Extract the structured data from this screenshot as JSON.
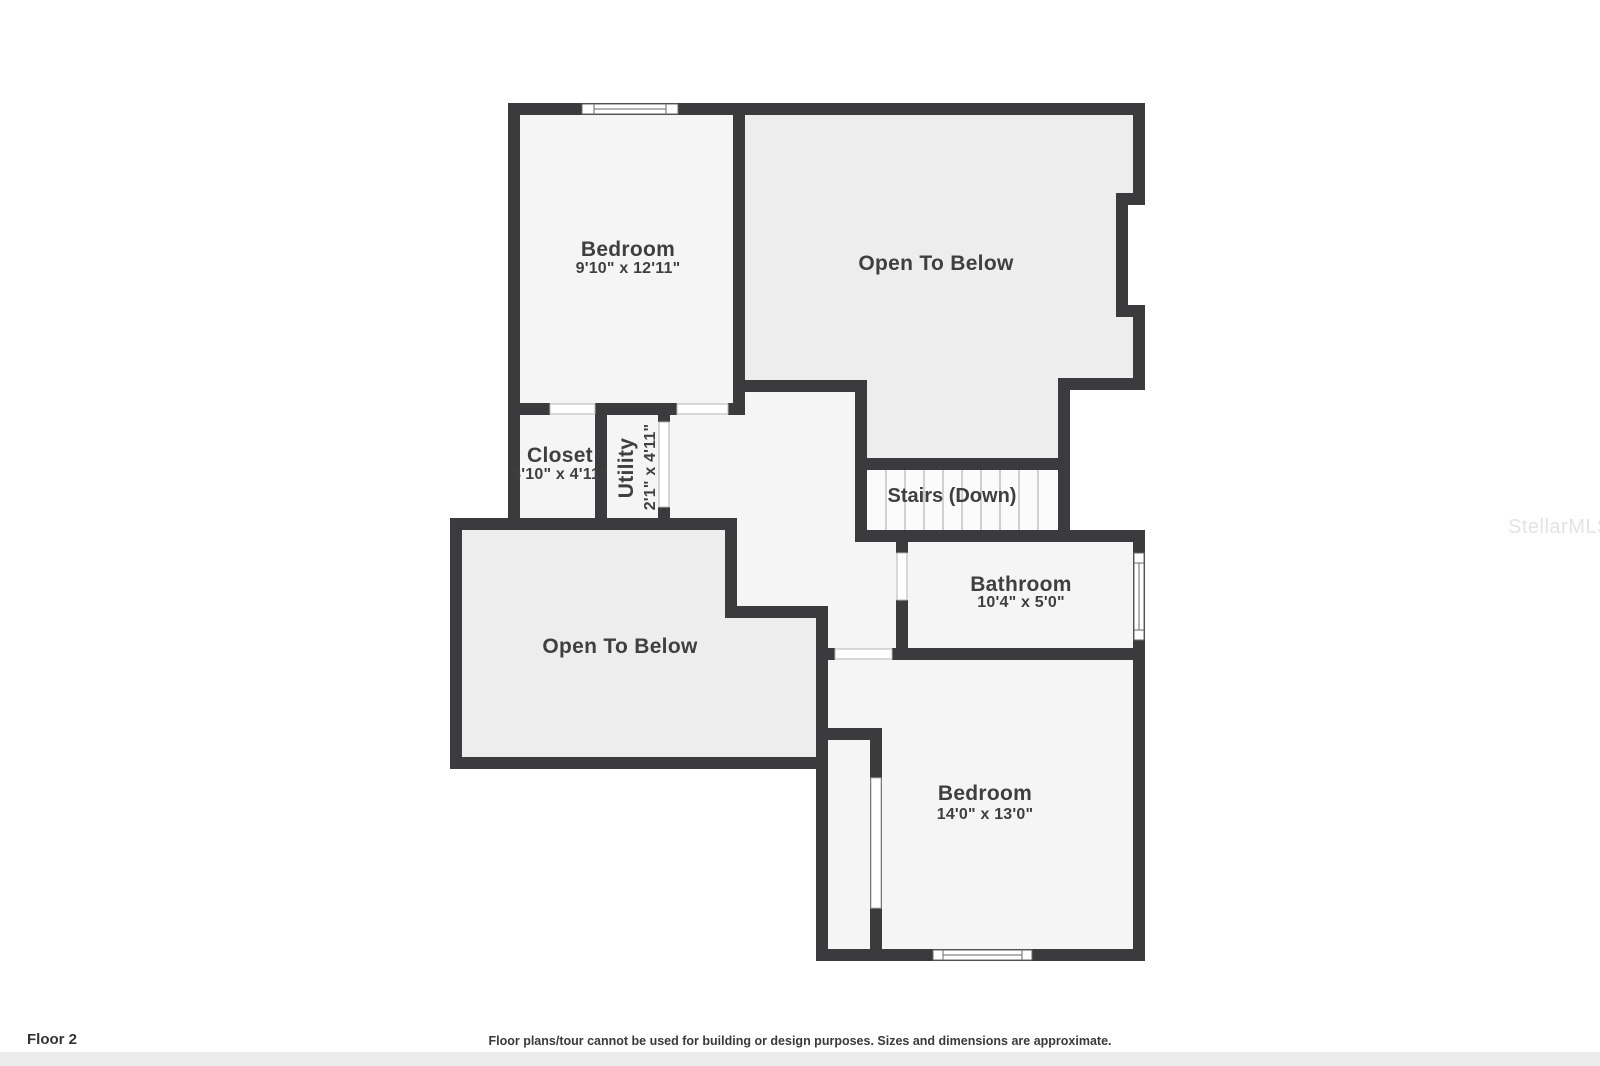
{
  "page": {
    "floor_label": "Floor 2",
    "disclaimer": "Floor plans/tour cannot be used for building or design purposes. Sizes and dimensions are approximate.",
    "watermark": "StellarMLS"
  },
  "rooms": {
    "bedroom_top": {
      "label": "Bedroom",
      "dims": "9'10\" x 12'11\""
    },
    "open_below_upper": {
      "label": "Open To Below"
    },
    "closet": {
      "label": "Closet",
      "dims": "3'10\" x 4'11\""
    },
    "utility": {
      "label": "Utility",
      "dims": "2'1\" x 4'11\""
    },
    "stairs": {
      "label": "Stairs (Down)"
    },
    "bathroom": {
      "label": "Bathroom",
      "dims": "10'4\" x 5'0\""
    },
    "open_below_lower": {
      "label": "Open To Below"
    },
    "bedroom_bottom": {
      "label": "Bedroom",
      "dims": "14'0\" x 13'0\""
    }
  },
  "colors": {
    "wall": "#3b3b3d",
    "room-fill": "#f5f5f5",
    "open-fill": "#ededed",
    "stairs-fill": "#fbfbfb",
    "label-color": "#3f3f3f",
    "tread-line": "#b3b3b3",
    "footer-strip": "#ececec",
    "watermark-color": "#e4e4e4"
  }
}
